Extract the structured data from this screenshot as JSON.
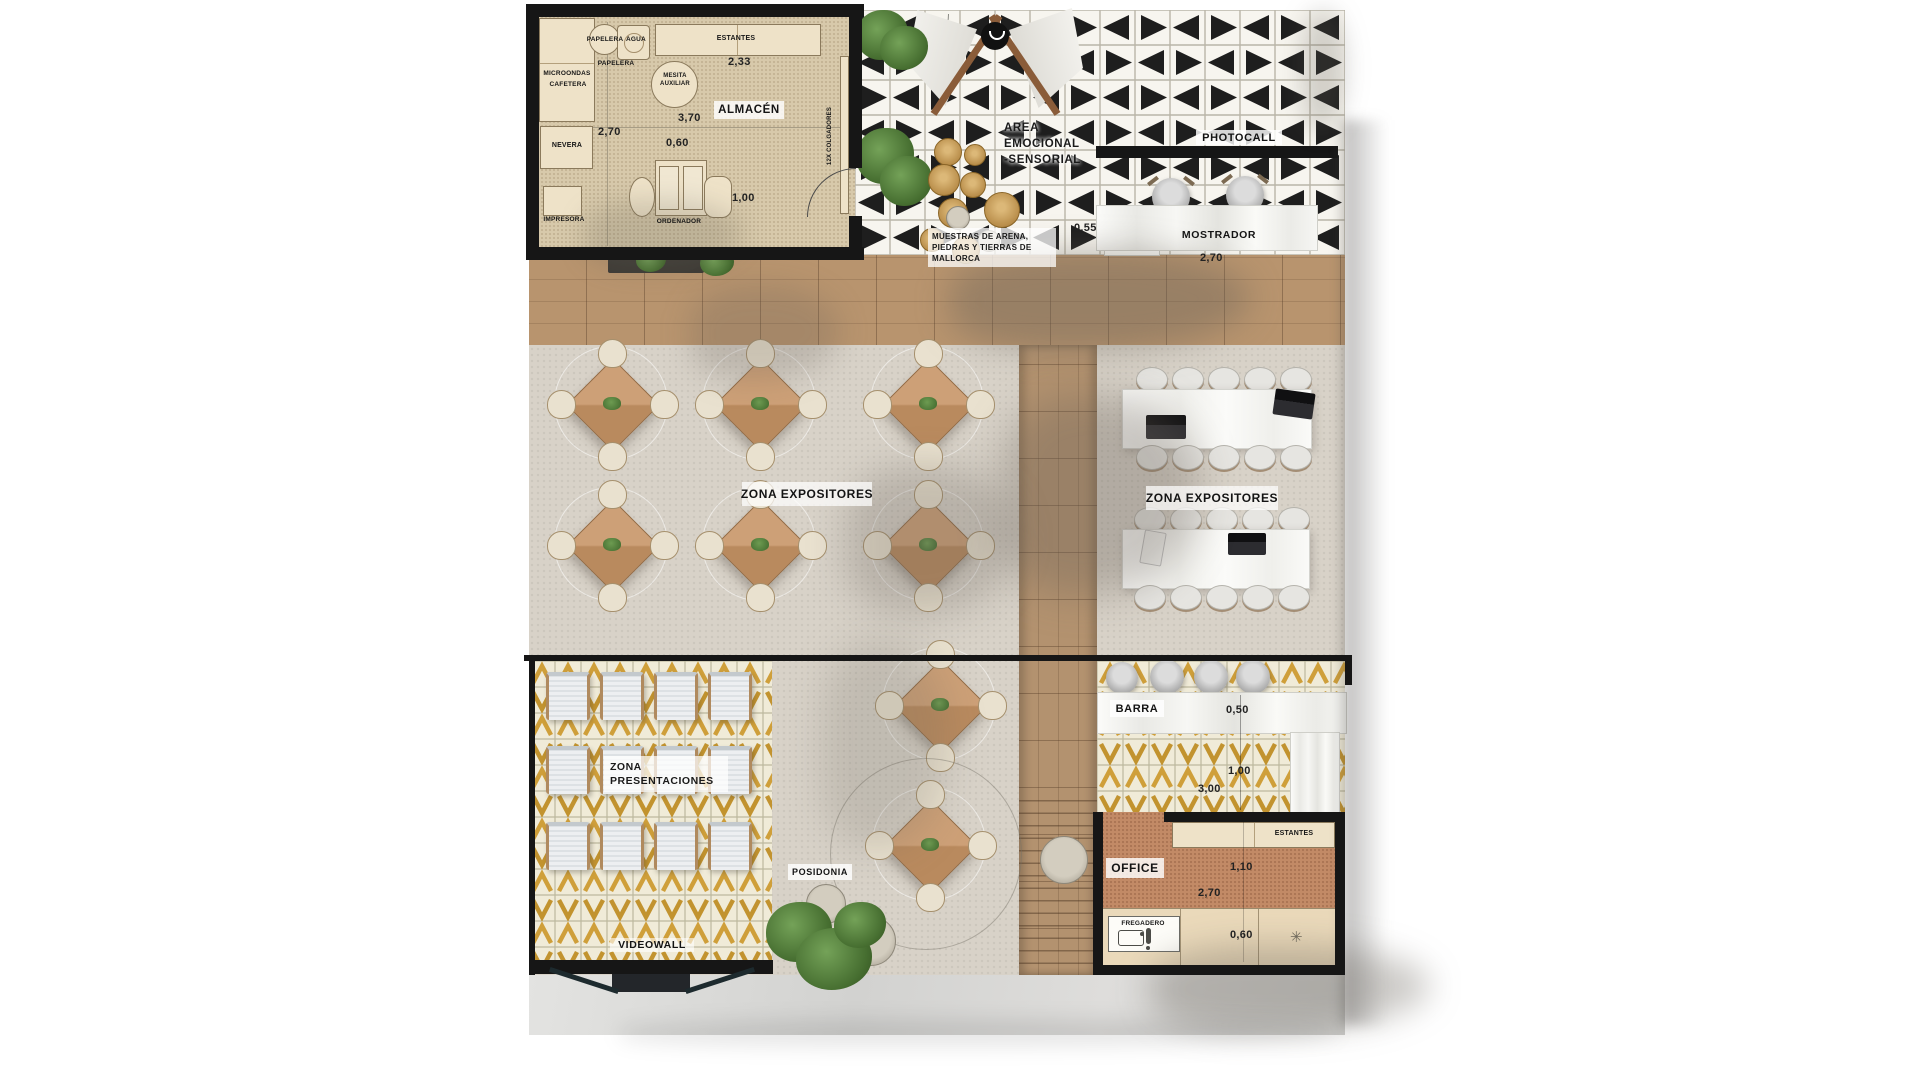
{
  "plan": {
    "almacen": {
      "title": "ALMACÉN",
      "papelera_a": "PAPELERA",
      "agua": "AGUA",
      "papelera_b": "PAPELERA",
      "estantes": "ESTANTES",
      "dim_estantes": "2,33",
      "microondas": "MICROONDAS",
      "cafetera": "CAFETERA",
      "mesita_line1": "MESITA",
      "mesita_line2": "AUXILIAR",
      "dim_ancho": "3,70",
      "dim_alto": "2,70",
      "dim_mesa": "0,60",
      "nevera": "NEVERA",
      "impresora": "IMPRESORA",
      "ordenador": "ORDENADOR",
      "dim_puerta": "1,00",
      "colgadores": "12X COLGADORES"
    },
    "sensorial": {
      "title_line1": "AREA",
      "title_line2": "EMOCIONAL",
      "title_line3": "-SENSORIAL",
      "muestras_line1": "MUESTRAS DE ARENA,",
      "muestras_line2": "PIEDRAS Y TIERRAS DE",
      "muestras_line3": "MALLORCA",
      "dim": "0,55"
    },
    "photocall": {
      "title": "PHOTOCALL"
    },
    "mostrador": {
      "title": "MOSTRADOR",
      "dim": "2,70"
    },
    "expositores_left": {
      "title": "ZONA EXPOSITORES"
    },
    "expositores_right": {
      "title": "ZONA EXPOSITORES"
    },
    "presentaciones": {
      "line1": "ZONA",
      "line2": "PRESENTACIONES"
    },
    "videowall": {
      "title": "VIDEOWALL"
    },
    "posidonia": {
      "title": "POSIDONIA"
    },
    "barra": {
      "title": "BARRA",
      "dim_a": "0,50",
      "dim_b": "1,00",
      "dim_c": "3,00"
    },
    "office": {
      "title": "OFFICE",
      "estantes": "ESTANTES",
      "dim_a": "1,10",
      "dim_b": "2,70",
      "fregadero": "FREGADERO",
      "dim_c": "0,60"
    }
  },
  "icons": {
    "sun": "✳"
  },
  "colors": {
    "wood": "#b8946e",
    "gold_tile": "#cf9f3a",
    "wall": "#161616",
    "terracotta": "#c28a66",
    "concrete": "#d8d2c8",
    "beige_floor": "#d7c9ab"
  }
}
